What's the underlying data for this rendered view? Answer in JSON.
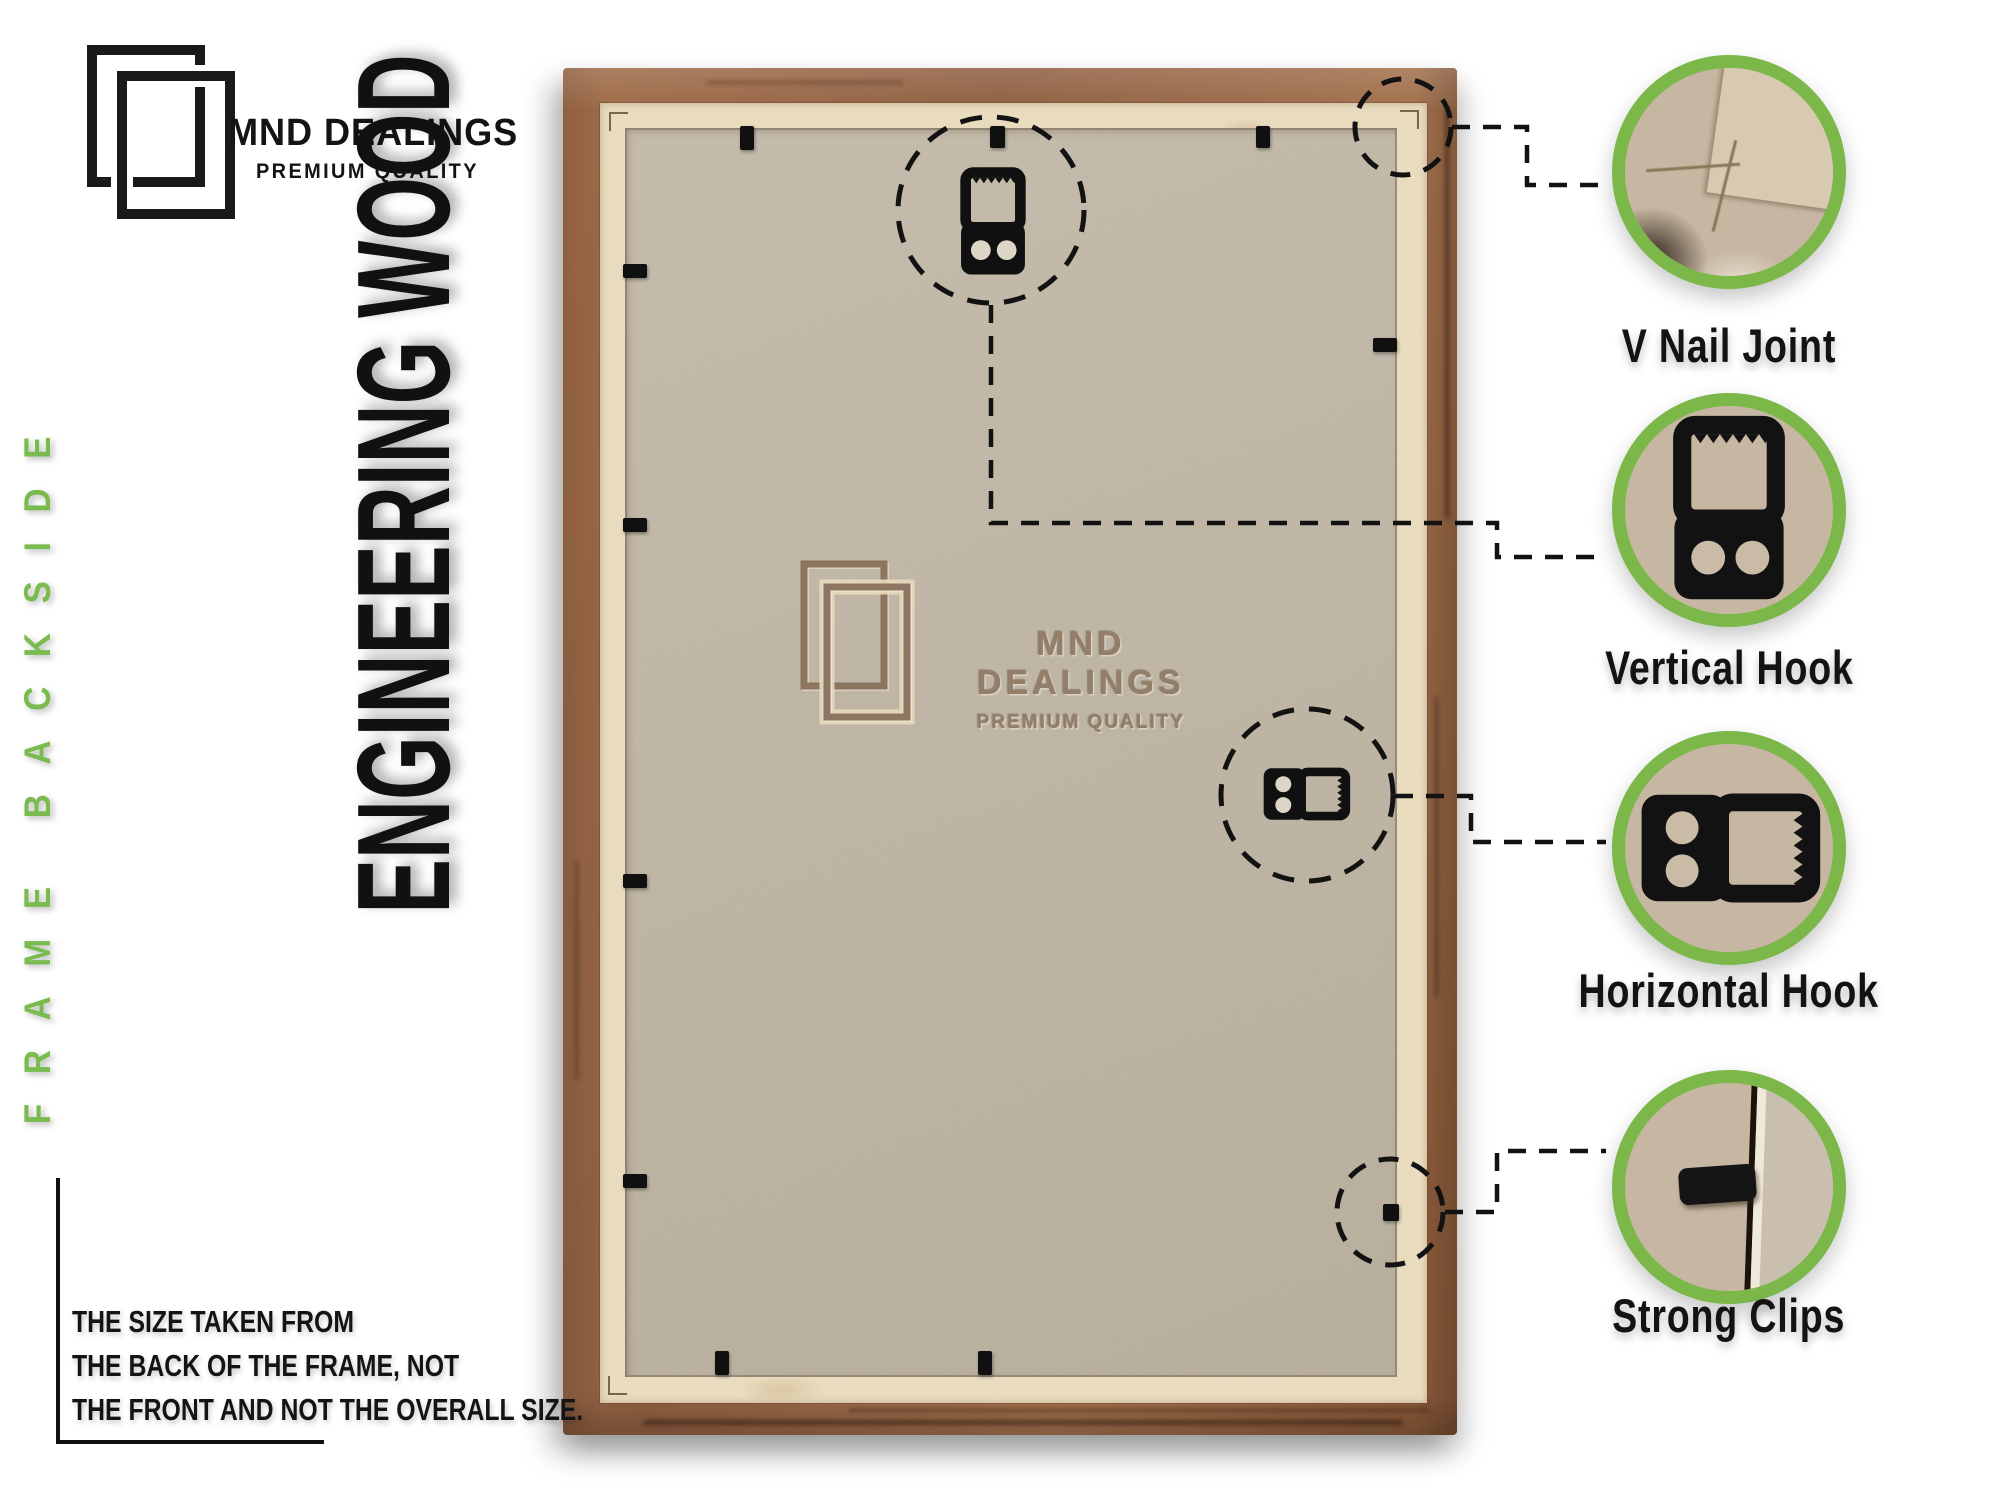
{
  "brand": {
    "name": "MND DEALINGS",
    "tagline": "PREMIUM QUALITY"
  },
  "side_label": "FRAME BACKSIDE",
  "material_label": "ENGINEERING WOOD",
  "watermark": {
    "name": "MND DEALINGS",
    "tagline": "PREMIUM QUALITY"
  },
  "note": {
    "lines": [
      "THE SIZE TAKEN FROM",
      "THE BACK OF THE FRAME, NOT",
      "THE FRONT AND NOT THE OVERALL SIZE."
    ]
  },
  "callouts": [
    {
      "label": "V Nail Joint"
    },
    {
      "label": "Vertical Hook"
    },
    {
      "label": "Horizontal Hook"
    },
    {
      "label": "Strong Clips"
    }
  ],
  "colors": {
    "accent_green": "#7cb74a",
    "green_text": "#79bb4e",
    "ink": "#141414",
    "wood": "#9a6848",
    "cream": "#ecdec0",
    "mdf": "#c3b9a8",
    "callout_bg": "#c9b9a4"
  }
}
